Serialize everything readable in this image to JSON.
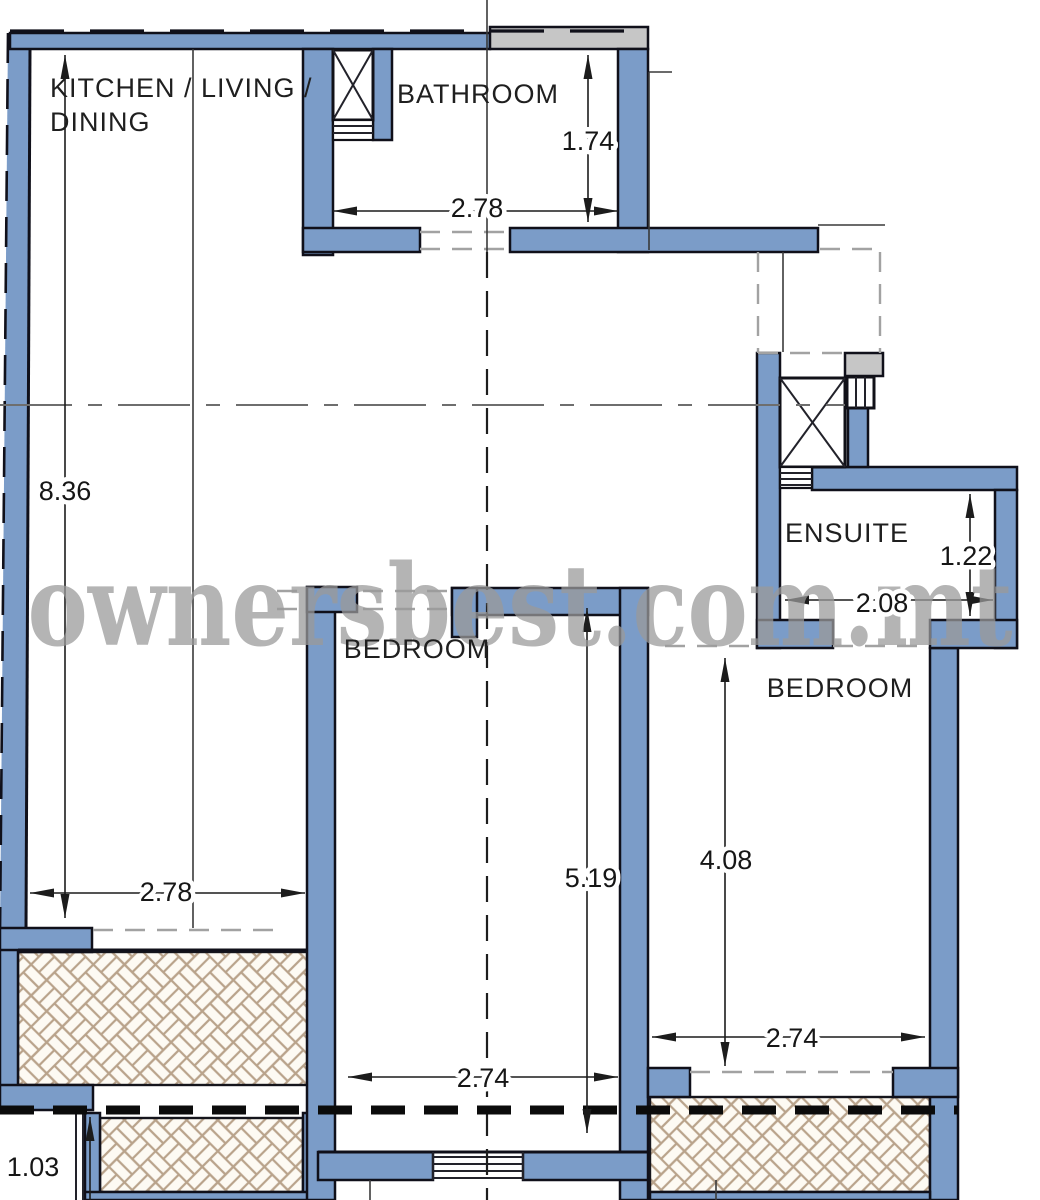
{
  "watermark": "ownersbest.com.mt",
  "rooms": {
    "kitchen": {
      "label_line1": "KITCHEN / LIVING /",
      "label_line2": "DINING",
      "width_m": "2.78",
      "height_m": "8.36"
    },
    "bathroom": {
      "label": "BATHROOM",
      "width_m": "2.78",
      "height_m": "1.74"
    },
    "ensuite": {
      "label": "ENSUITE",
      "width_m": "2.08",
      "height_m": "1.22"
    },
    "bedroom_middle": {
      "label": "BEDROOM",
      "width_m": "2.74",
      "height_m": "5.19"
    },
    "bedroom_right": {
      "label": "BEDROOM",
      "width_m": "2.74",
      "height_m": "4.08"
    },
    "terrace": {
      "depth_m": "1.03"
    }
  },
  "colors": {
    "wall_blue": "#7b9cc8",
    "wall_outline": "#10101a",
    "party_wall_gray": "#c6c6c6",
    "hatch_line": "#b9a38b",
    "hatch_background": "#fdfaf3",
    "watermark_gray": "#9a9a9a",
    "centerline_gray": "#6e6e6e",
    "opening_dash_gray": "#a2a2a2"
  }
}
